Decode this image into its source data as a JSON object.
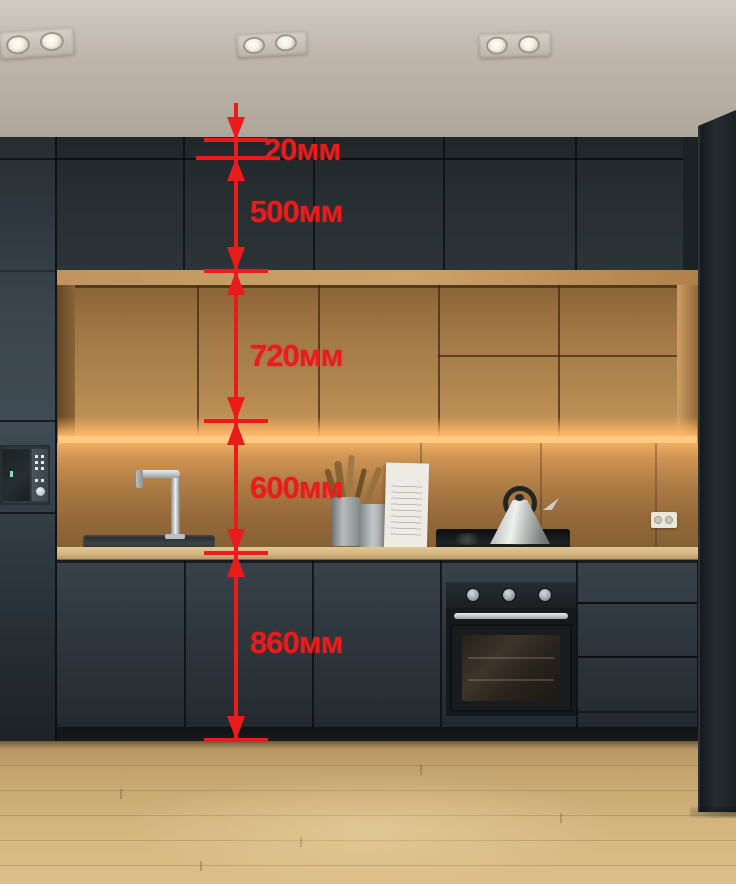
{
  "annotation": {
    "accent_color": "#ea1b1b",
    "unit": "мм",
    "measurements": [
      {
        "name": "ceiling-filler-gap",
        "value": "20мм"
      },
      {
        "name": "upper-cabinet-height",
        "value": "500мм"
      },
      {
        "name": "wall-cabinet-height",
        "value": "720мм"
      },
      {
        "name": "backsplash-height",
        "value": "600мм"
      },
      {
        "name": "base-cabinet-height",
        "value": "860мм"
      }
    ]
  },
  "palette": {
    "cabinet_dark": "#272e32",
    "wood_cabinet": "#a87e4c",
    "countertop": "#d2b47f",
    "floor_wood": "#cfae76",
    "ceiling": "#b7afa4",
    "led_glow": "#ffb469"
  }
}
